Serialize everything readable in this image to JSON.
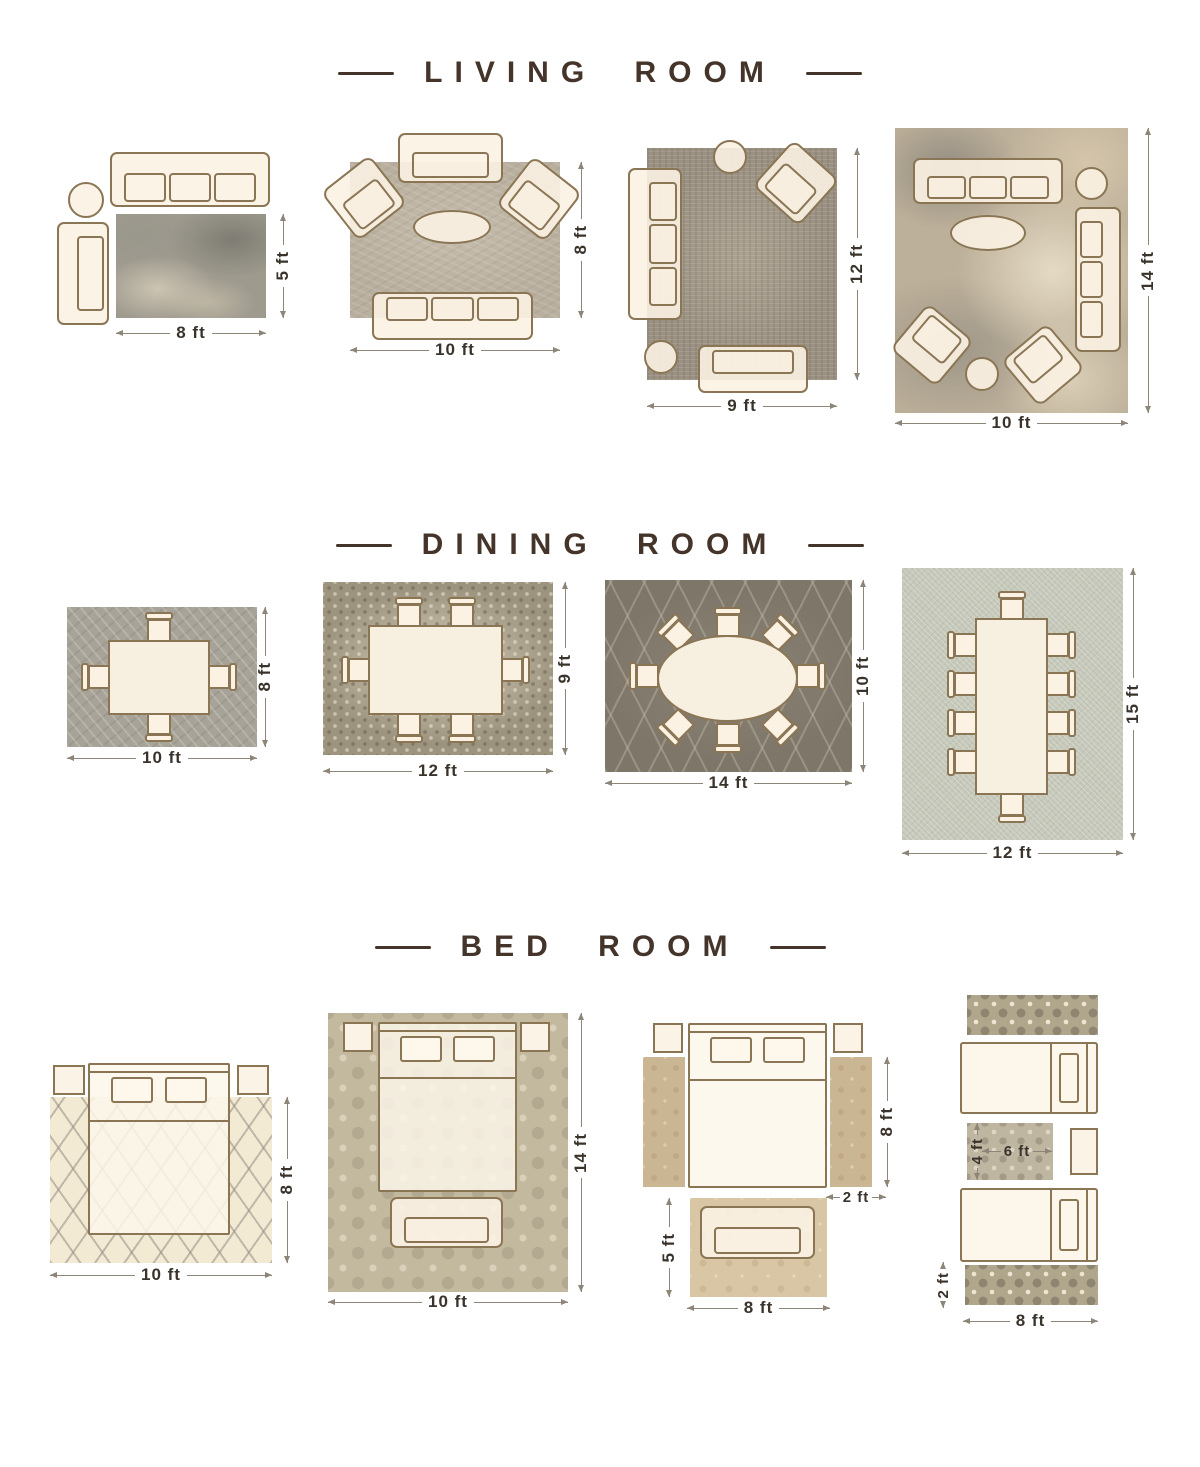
{
  "title": "Rug placement size guide",
  "colors": {
    "background": "#ffffff",
    "header_text": "#44342a",
    "dimension_text": "#3a332b",
    "dimension_line": "#8c8578",
    "furniture_outline": "#8a7654",
    "furniture_fill": "#fbf2e3"
  },
  "sections": [
    {
      "title": "LIVING ROOM",
      "layouts": [
        {
          "rug": "distressed gray rug",
          "furniture": [
            "sofa",
            "side-table",
            "chaise"
          ],
          "labels": {
            "width": "8 ft",
            "height": "5 ft"
          }
        },
        {
          "rug": "textured taupe rug",
          "furniture": [
            "loveseat",
            "armchair",
            "armchair",
            "coffee-table",
            "sofa"
          ],
          "labels": {
            "width": "10 ft",
            "height": "8 ft"
          }
        },
        {
          "rug": "vintage distressed rug",
          "furniture": [
            "sofa",
            "side-table",
            "armchair",
            "side-table",
            "loveseat"
          ],
          "labels": {
            "width": "9 ft",
            "height": "12 ft"
          }
        },
        {
          "rug": "abstract marbled rug",
          "furniture": [
            "sofa",
            "side-table",
            "sofa",
            "coffee-table",
            "armchair",
            "armchair",
            "side-table"
          ],
          "labels": {
            "width": "10 ft",
            "height": "14 ft"
          }
        }
      ]
    },
    {
      "title": "DINING ROOM",
      "layouts": [
        {
          "rug": "textured gray rug",
          "furniture": [
            "dining-table",
            "chair x4"
          ],
          "labels": {
            "width": "10 ft",
            "height": "8 ft"
          }
        },
        {
          "rug": "mosaic pebble rug",
          "furniture": [
            "dining-table",
            "chair x6"
          ],
          "labels": {
            "width": "12 ft",
            "height": "9 ft"
          }
        },
        {
          "rug": "dark trellis rug",
          "furniture": [
            "oval-dining-table",
            "chair x8"
          ],
          "labels": {
            "width": "14 ft",
            "height": "10 ft"
          }
        },
        {
          "rug": "light woven rug",
          "furniture": [
            "long-dining-table",
            "chair x10"
          ],
          "labels": {
            "width": "12 ft",
            "height": "15 ft"
          }
        }
      ]
    },
    {
      "title": "BED ROOM",
      "layouts": [
        {
          "rug": "cream trellis rug",
          "furniture": [
            "bed",
            "nightstand x2"
          ],
          "labels": {
            "width": "10 ft",
            "height": "8 ft"
          }
        },
        {
          "rug": "damask rug",
          "furniture": [
            "bed",
            "nightstand x2",
            "bench"
          ],
          "labels": {
            "width": "10 ft",
            "height": "14 ft"
          }
        },
        {
          "rug": "bedside runners and foot rug",
          "furniture": [
            "bed",
            "nightstand x2",
            "runner x2",
            "loveseat"
          ],
          "labels": {
            "runner_length": "8 ft",
            "runner_width": "2 ft",
            "foot_rug_height": "5 ft",
            "foot_rug_width": "8 ft"
          }
        },
        {
          "rug": "twin runners and accent rug",
          "furniture": [
            "twin-bed x2",
            "runner x2",
            "accent-rug",
            "nightstand"
          ],
          "labels": {
            "accent_height": "4 ft",
            "accent_width": "6 ft",
            "runner_height": "2 ft",
            "runner_length": "8 ft"
          }
        }
      ]
    }
  ]
}
